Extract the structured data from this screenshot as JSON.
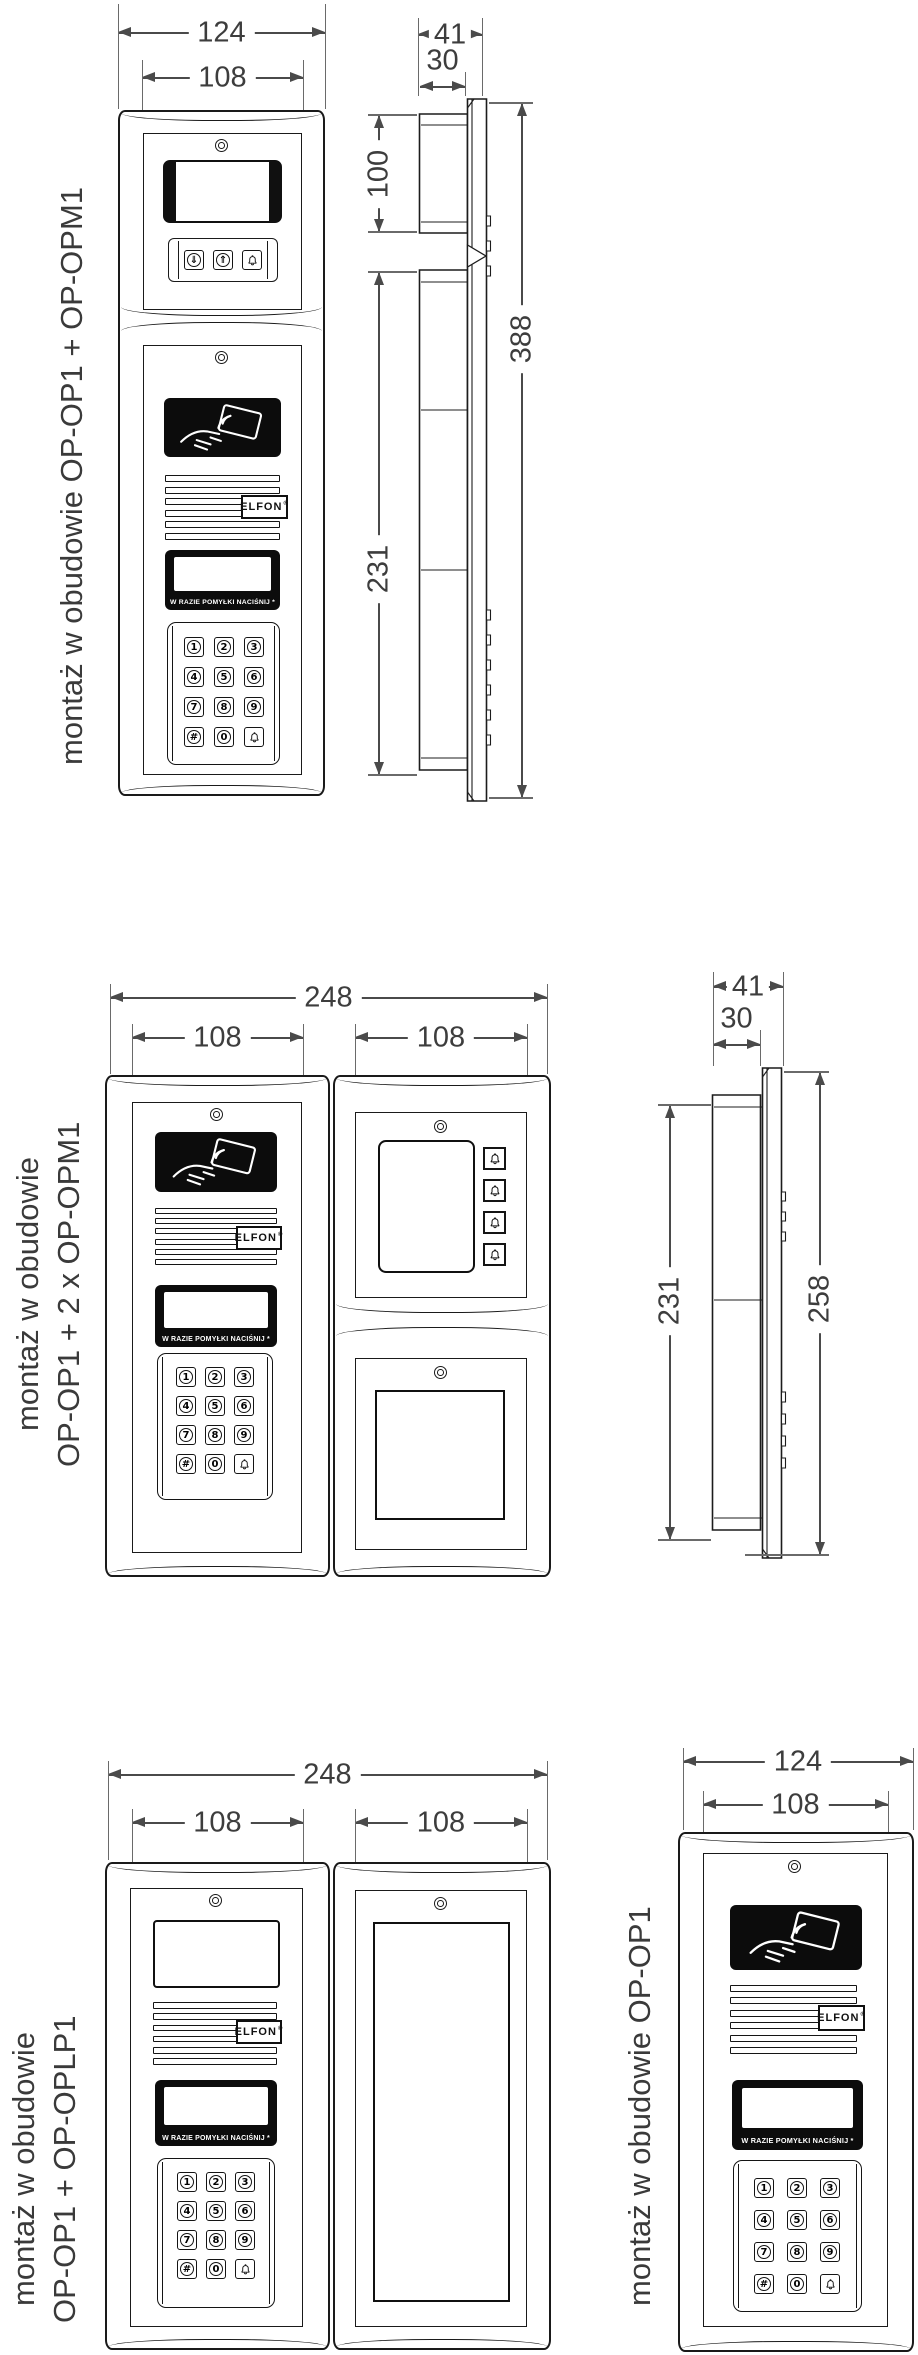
{
  "diagram": {
    "brand": "ELFON",
    "brand_reg": "®",
    "display_caption": "W RAZIE POMYŁKI NACIŚNIJ *",
    "keypad_keys": [
      "1",
      "2",
      "3",
      "4",
      "5",
      "6",
      "7",
      "8",
      "9",
      "#",
      "0",
      "bell"
    ],
    "opm_buttons": [
      "⇓",
      "⇑",
      "bell"
    ],
    "bell_column": [
      "bell",
      "bell",
      "bell",
      "bell"
    ]
  },
  "sections": {
    "s1": {
      "label": "montaż w obudowie OP-OP1 + OP-OPM1",
      "dims": {
        "overall_width": "124",
        "module_width": "108",
        "depth": "41",
        "box_depth": "30",
        "top_module_height": "100",
        "bottom_module_height": "231",
        "total_height": "388"
      }
    },
    "s2": {
      "label_line1": "montaż w obudowie",
      "label_line2": "OP-OP1 + 2 x OP-OPM1",
      "dims": {
        "overall_width": "248",
        "left_module_width": "108",
        "right_module_width": "108",
        "depth": "41",
        "box_depth": "30",
        "box_height": "231",
        "panel_height": "258"
      }
    },
    "s3": {
      "label_line1": "montaż w obudowie",
      "label_line2": "OP-OP1 + OP-OPLP1",
      "dims": {
        "overall_width": "248",
        "left_module_width": "108",
        "right_module_width": "108"
      }
    },
    "s4": {
      "label": "montaż w obudowie OP-OP1",
      "dims": {
        "overall_width": "124",
        "module_width": "108"
      }
    }
  }
}
